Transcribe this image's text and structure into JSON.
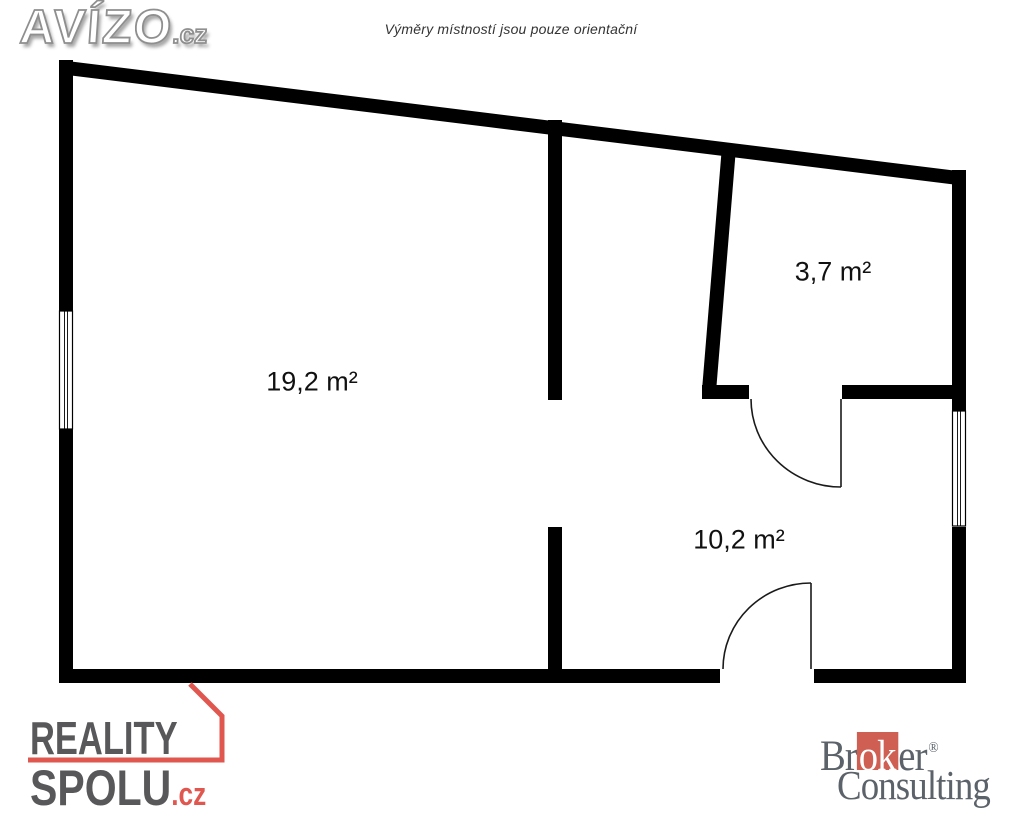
{
  "disclaimer": "Výměry místností jsou pouze orientační",
  "rooms": [
    {
      "name": "main-room",
      "area_label": "19,2 m²"
    },
    {
      "name": "small-room",
      "area_label": "3,7 m²"
    },
    {
      "name": "hall-room",
      "area_label": "10,2 m²"
    }
  ],
  "logos": {
    "avizo": {
      "brand": "AVÍZO",
      "tld": ".cz"
    },
    "reality_spolu": {
      "line1": "REALITY",
      "line2": "SPOLU",
      "tld": ".cz",
      "text_color": "#58585a",
      "accent_color": "#e0574f"
    },
    "broker_consulting": {
      "pre": "Br",
      "highlight": "ok",
      "post": "er",
      "registered": "®",
      "line2": "Consulting",
      "text_color": "#5b6269",
      "accent_color": "#cf5e53"
    }
  },
  "plan": {
    "wall_color": "#000000",
    "background": "#ffffff"
  }
}
